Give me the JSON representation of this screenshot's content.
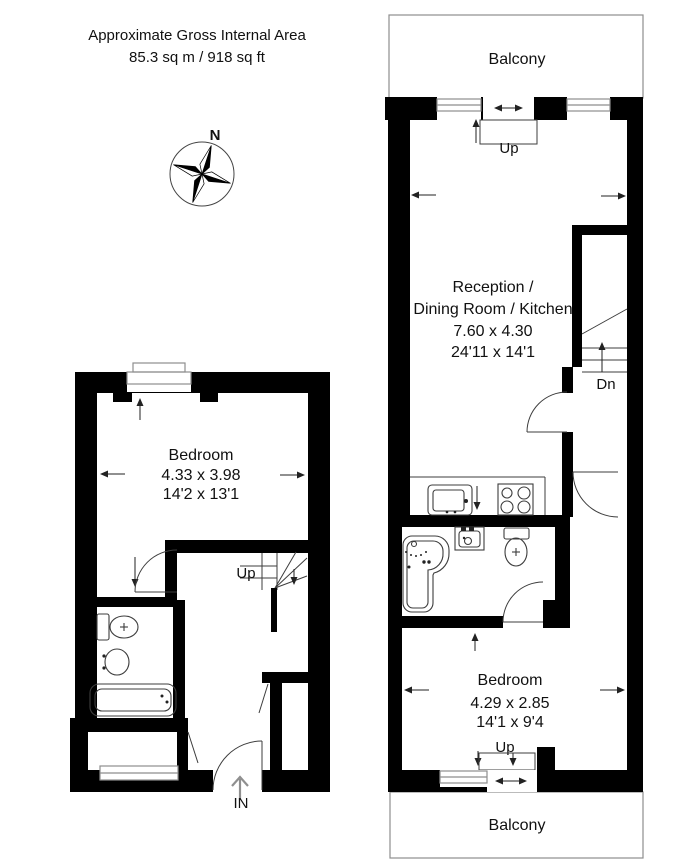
{
  "header": {
    "line1": "Approximate Gross Internal Area",
    "line2": "85.3 sq m / 918 sq ft"
  },
  "compass": {
    "north": "N"
  },
  "upper_floor": {
    "balcony_top": {
      "label": "Balcony"
    },
    "balcony_door": {
      "label": "Up"
    },
    "reception": {
      "line1": "Reception /",
      "line2": "Dining Room / Kitchen",
      "size_metric": "7.60 x 4.30",
      "size_imperial": "24'11 x 14'1"
    },
    "stairs_down": {
      "label": "Dn"
    },
    "bedroom": {
      "name": "Bedroom",
      "size_metric": "4.29 x 2.85",
      "size_imperial": "14'1 x 9'4",
      "door_label": "Up"
    },
    "balcony_bottom": {
      "label": "Balcony"
    }
  },
  "lower_floor": {
    "bedroom": {
      "name": "Bedroom",
      "size_metric": "4.33 x 3.98",
      "size_imperial": "14'2 x 13'1"
    },
    "stairs_up": {
      "label": "Up"
    },
    "entrance": {
      "label": "IN"
    }
  },
  "colors": {
    "wall": "#000000",
    "line": "#3d3d3d",
    "muted_line": "#8e8e8e",
    "text": "#111111",
    "entrance_arrow": "#8f8f8f",
    "background": "#ffffff"
  }
}
